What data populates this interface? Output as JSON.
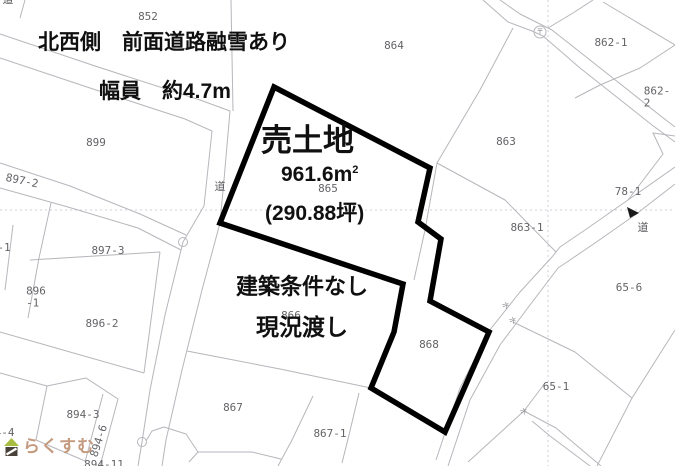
{
  "page": {
    "width": 675,
    "height": 466,
    "background": "#ffffff"
  },
  "map": {
    "annotations": {
      "road_note_line1": "北西側　前面道路融雪あり",
      "road_note_line2": "幅員　約4.7m",
      "sale_title": "売土地",
      "area_value": "961.6",
      "area_unit": "m",
      "area_unit_exp": "2",
      "area_tsubo": "(290.88坪)",
      "condition_line1": "建築条件なし",
      "condition_line2": "現況渡し"
    },
    "parcel_labels": [
      {
        "name": "parcel-label-852",
        "text": "852",
        "x": 148,
        "y": 17
      },
      {
        "name": "parcel-label-864",
        "text": "864",
        "x": 394,
        "y": 46
      },
      {
        "name": "parcel-label-862-1",
        "text": "862-1",
        "x": 611,
        "y": 43
      },
      {
        "name": "parcel-label-862-2",
        "text": "862-2",
        "x": 657,
        "y": 97
      },
      {
        "name": "parcel-label-899",
        "text": "899",
        "x": 96,
        "y": 143
      },
      {
        "name": "parcel-label-863",
        "text": "863",
        "x": 506,
        "y": 142
      },
      {
        "name": "parcel-label-897-2",
        "text": "897-2",
        "x": 22,
        "y": 181,
        "rot": 12
      },
      {
        "name": "road-label-top-left",
        "text": "道",
        "x": 8,
        "y": 0,
        "cls": "road"
      },
      {
        "name": "road-label-center",
        "text": "道",
        "x": 220,
        "y": 187,
        "cls": "road"
      },
      {
        "name": "parcel-label-865",
        "text": "865",
        "x": 328,
        "y": 189
      },
      {
        "name": "parcel-label-78-1",
        "text": "78-1",
        "x": 628,
        "y": 192
      },
      {
        "name": "road-label-right",
        "text": "道",
        "x": 643,
        "y": 228,
        "cls": "road"
      },
      {
        "name": "parcel-label-863-1",
        "text": "863-1",
        "x": 527,
        "y": 228
      },
      {
        "name": "parcel-label-fragment-1",
        "text": "-1",
        "x": 4,
        "y": 248
      },
      {
        "name": "parcel-label-897-3",
        "text": "897-3",
        "x": 108,
        "y": 251
      },
      {
        "name": "parcel-label-65-6",
        "text": "65-6",
        "x": 629,
        "y": 288
      },
      {
        "name": "parcel-label-896-1",
        "text": "896\n-1",
        "x": 36,
        "y": 297
      },
      {
        "name": "parcel-label-866",
        "text": "866",
        "x": 291,
        "y": 316
      },
      {
        "name": "parcel-label-896-2",
        "text": "896-2",
        "x": 102,
        "y": 324
      },
      {
        "name": "parcel-label-868",
        "text": "868",
        "x": 429,
        "y": 345
      },
      {
        "name": "parcel-label-65-1",
        "text": "65-1",
        "x": 556,
        "y": 387
      },
      {
        "name": "parcel-label-867",
        "text": "867",
        "x": 233,
        "y": 408
      },
      {
        "name": "parcel-label-894-3",
        "text": "894-3",
        "x": 83,
        "y": 415
      },
      {
        "name": "parcel-label-867-1",
        "text": "867-1",
        "x": 330,
        "y": 434
      },
      {
        "name": "parcel-label-894-4",
        "text": "894-4",
        "x": -2,
        "y": 433
      },
      {
        "name": "parcel-label-894-6",
        "text": "894-6",
        "x": 99,
        "y": 441,
        "rot": -72
      },
      {
        "name": "parcel-label-894-11",
        "text": "894-11",
        "x": 104,
        "y": 465
      },
      {
        "name": "marker-label-post",
        "text": "〒",
        "x": 540,
        "y": 32,
        "cls": "tiny"
      },
      {
        "name": "water-mark-1",
        "text": "水",
        "x": 505,
        "y": 306,
        "rot": 50,
        "cls": "tiny"
      },
      {
        "name": "water-mark-2",
        "text": "水",
        "x": 512,
        "y": 321,
        "rot": 50,
        "cls": "tiny"
      },
      {
        "name": "water-mark-3",
        "text": "水",
        "x": 523,
        "y": 412,
        "rot": 50,
        "cls": "tiny"
      }
    ],
    "property": {
      "sale_parcel_numbers": [
        "865",
        "868"
      ],
      "outline_color": "#000000"
    },
    "logo": {
      "text": "らくすむ",
      "text_color": "#c49a7e",
      "roof_color": "#a8bc3f",
      "body_color": "#4a423a"
    }
  },
  "colors": {
    "background": "#ffffff",
    "thin_line": "#b6b6bc",
    "dashed_line": "#cdd1d9",
    "parcel_label": "#646468",
    "annotation_text": "#101010"
  }
}
